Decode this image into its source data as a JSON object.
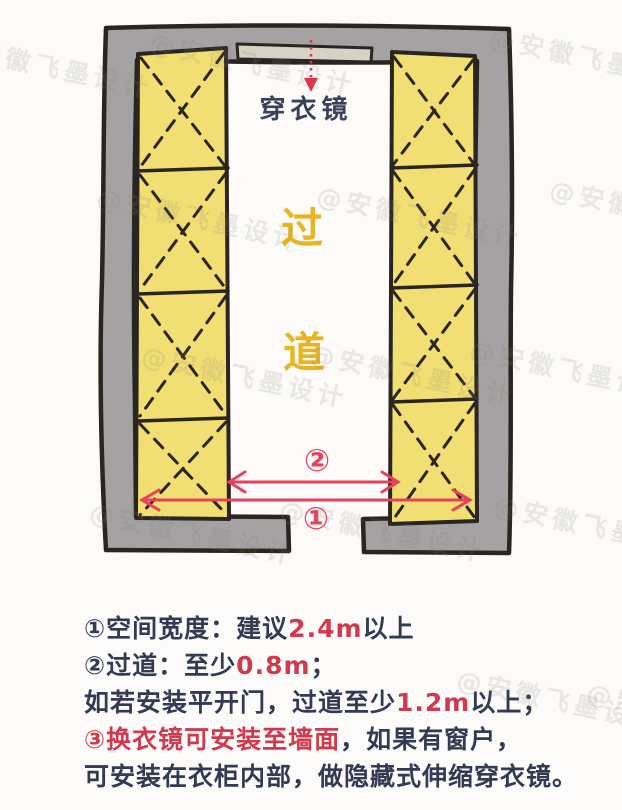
{
  "watermark": {
    "text": "@安徽飞墨设计"
  },
  "diagram": {
    "mirror_label": "穿衣镜",
    "aisle_char_1": "过",
    "aisle_char_2": "道",
    "dim_total_width_label": "①",
    "dim_aisle_label": "②",
    "colors": {
      "wall_fill": "#a4a2a3",
      "outline": "#2b2520",
      "wardrobe_fill": "#f1df73",
      "mirror_fill": "#d9d1c4",
      "dimension_red": "#e8415c",
      "pointer_red": "#e0304e",
      "aisle_gold": "#e6b51f",
      "ink": "#39425a"
    }
  },
  "notes": {
    "line1": {
      "pre": "①空间宽度：建议",
      "value": "2.4m",
      "post": "以上"
    },
    "line2": {
      "pre": "②过道：至少",
      "value": "0.8m",
      "post": "；"
    },
    "line3": {
      "pre": "如若安装平开门，过道至少",
      "value": "1.2m",
      "post": "以上；"
    },
    "line4": {
      "red": "③换衣镜可安装至墙面",
      "rest": "，如果有窗户，"
    },
    "line5": {
      "text": "可安装在衣柜内部，做隐藏式伸缩穿衣镜。"
    }
  }
}
